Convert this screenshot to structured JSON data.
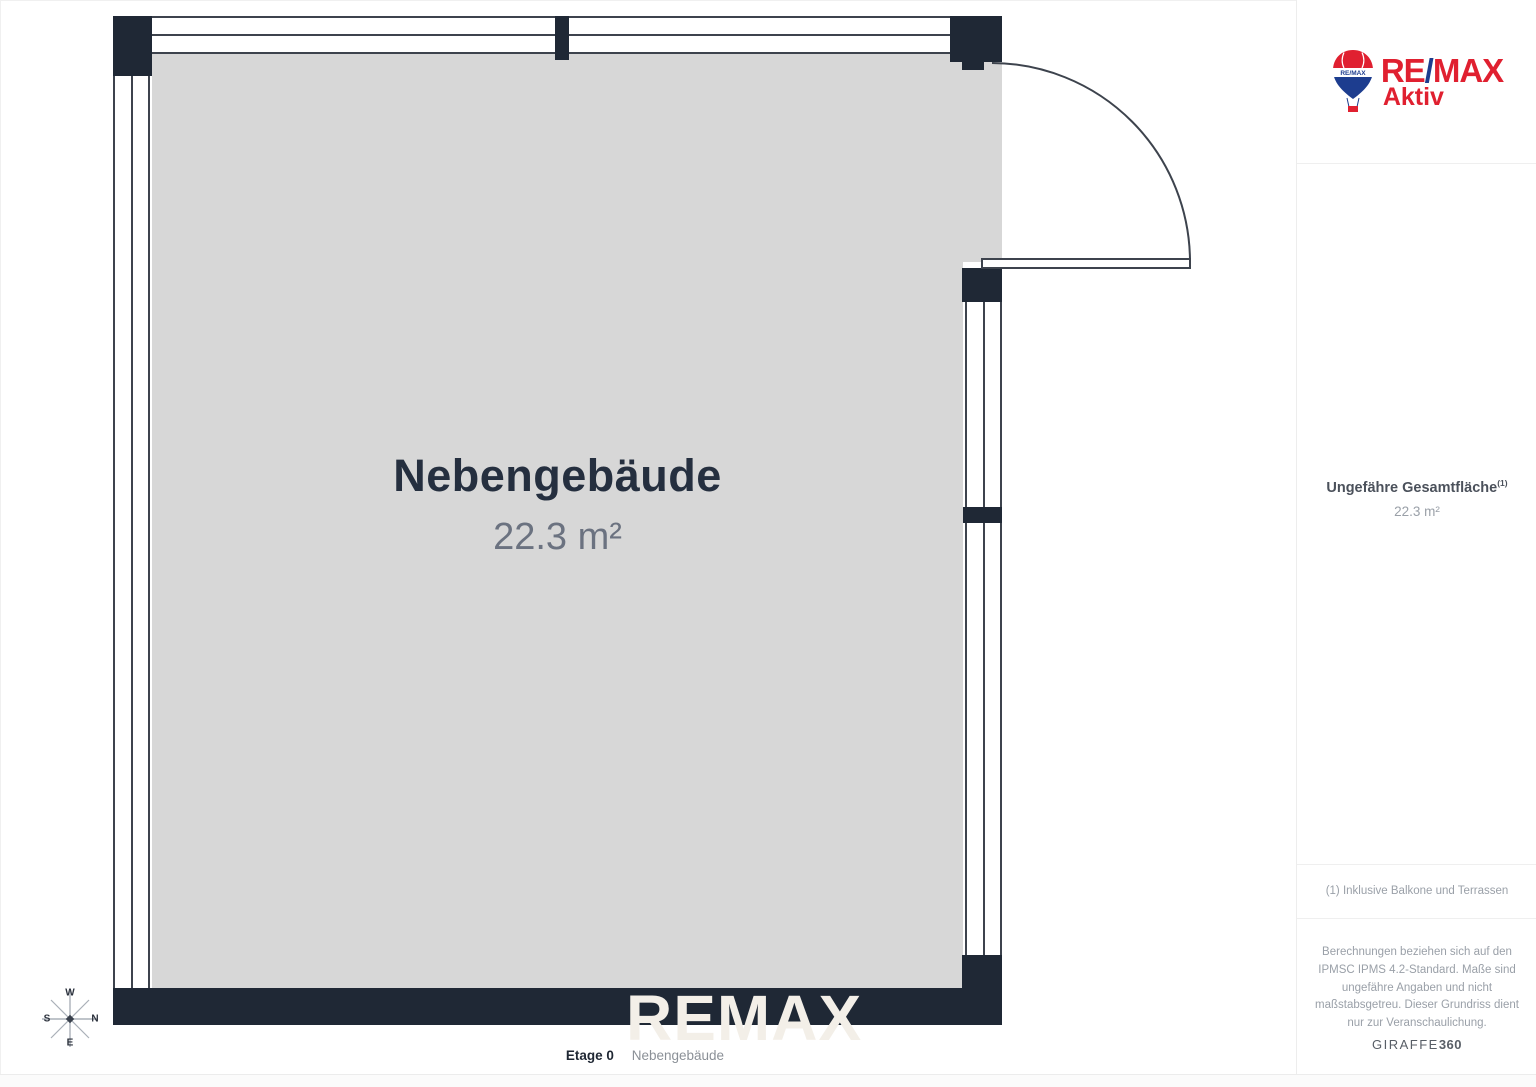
{
  "floor_plan": {
    "room": {
      "name": "Nebengebäude",
      "area": "22.3 m²"
    },
    "caption": {
      "floor": "Etage 0",
      "room": "Nebengebäude"
    },
    "watermark": "REMAX",
    "compass": {
      "top": "W",
      "right": "N",
      "bottom": "E",
      "left": "S"
    },
    "colors": {
      "wall": "#1f2835",
      "floor_fill": "#d7d7d7",
      "room_name_text": "#252f3f",
      "room_area_text": "#6b7280"
    }
  },
  "sidebar": {
    "logo": {
      "wordmark_re": "RE",
      "wordmark_slash": "/",
      "wordmark_max": "MAX",
      "subbrand": "Aktiv",
      "balloon_text": "RE/MAX",
      "colors": {
        "red": "#e02030",
        "blue": "#1d3d8f"
      }
    },
    "total_area": {
      "label": "Ungefähre Gesamtfläche",
      "footnote_ref": "(1)",
      "value": "22.3 m²"
    },
    "footnote": "(1) Inklusive Balkone und Terrassen",
    "disclaimer": "Berechnungen beziehen sich auf den IPMSC IPMS 4.2-Standard. Maße sind ungefähre Angaben und nicht maßstabsgetreu. Dieser Grundriss dient nur zur Veranschaulichung.",
    "vendor": {
      "name": "GIRAFFE",
      "suffix": "360"
    }
  }
}
